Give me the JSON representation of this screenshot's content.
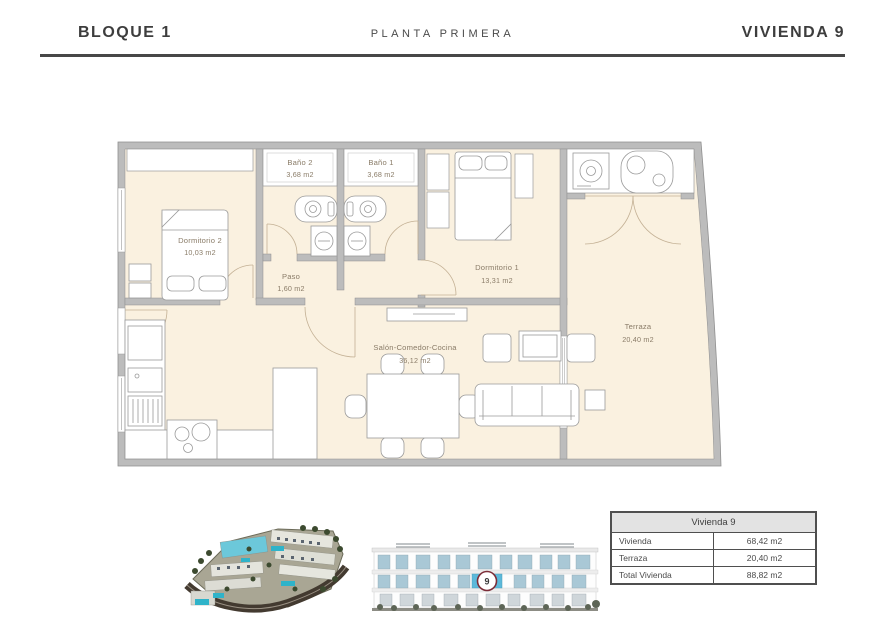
{
  "header": {
    "block_label": "BLOQUE 1",
    "floor_label": "PLANTA PRIMERA",
    "unit_label": "VIVIENDA 9"
  },
  "plan": {
    "rooms": [
      {
        "name": "Dormitorio 2",
        "area": "10,03 m2"
      },
      {
        "name": "Baño 2",
        "area": "3,68 m2"
      },
      {
        "name": "Baño 1",
        "area": "3,68 m2"
      },
      {
        "name": "Paso",
        "area": "1,60 m2"
      },
      {
        "name": "Dormitorio 1",
        "area": "13,31 m2"
      },
      {
        "name": "Salón-Comedor-Cocina",
        "area": "36,12 m2"
      },
      {
        "name": "Terraza",
        "area": "20,40 m2"
      }
    ],
    "colors": {
      "floor": "#faf1e0",
      "wall": "#bcbcbc",
      "wall_edge": "#8f8f8f",
      "label": "#8a7c68",
      "door_arc": "#c3b094"
    }
  },
  "elevation": {
    "unit_marker": "9",
    "marker_ring_color": "#7c2d38",
    "highlight_window_color": "#5cb9da"
  },
  "summary_table": {
    "title": "Vivienda 9",
    "rows": [
      {
        "label": "Vivienda",
        "value": "68,42 m2"
      },
      {
        "label": "Terraza",
        "value": "20,40 m2"
      },
      {
        "label": "Total Vivienda",
        "value": "88,82 m2"
      }
    ]
  }
}
